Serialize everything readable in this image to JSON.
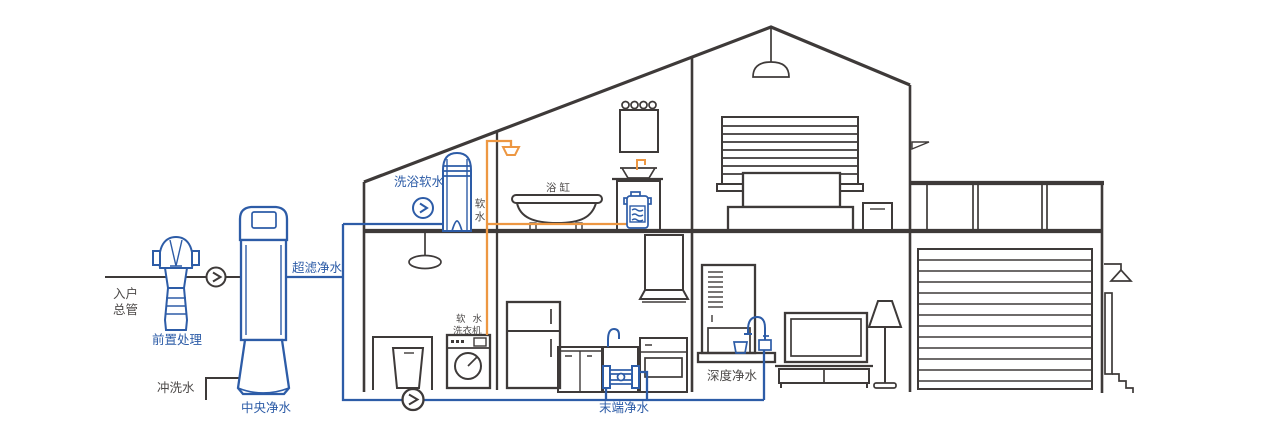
{
  "colors": {
    "background": "#FFFFFF",
    "blue": "#2D5CA7",
    "orange": "#ED9742",
    "ink": "#3E3A39",
    "textDark": "#4C4948"
  },
  "labels": {
    "entry_main_1": "入户",
    "entry_main_2": "总管",
    "pre_treatment": "前置处理",
    "central_purification": "中央净水",
    "flush_water": "冲洗水",
    "ultrafiltration": "超滤净水",
    "bath_softening": "洗浴软水",
    "soft_water_char_1": "软",
    "soft_water_char_2": "水",
    "bathtub": "浴缸",
    "soft_water_washer_1": "软 水",
    "soft_water_washer_2": "洗衣机",
    "terminal_purification": "末端净水",
    "deep_purification": "深度净水"
  }
}
